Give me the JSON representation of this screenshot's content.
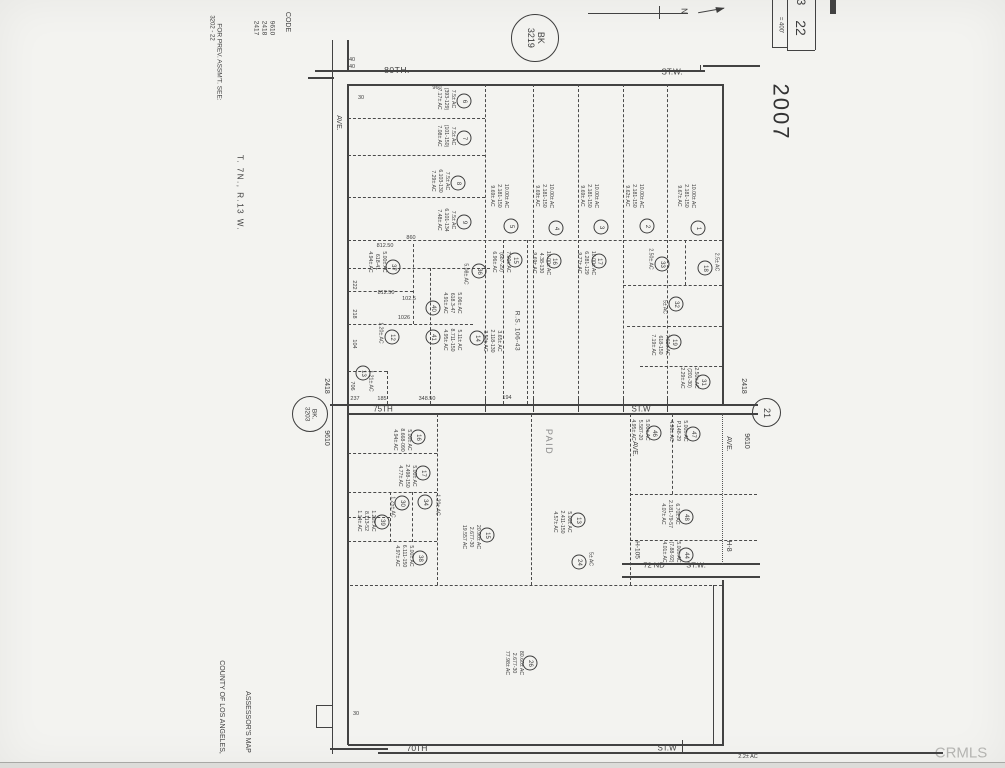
{
  "annotations": {
    "prev_assmt": "FOR PREV. ASSM'T. SEE:",
    "prev_assmt_ref": "3202 - 22",
    "code_label": "CODE",
    "code_list": [
      "9610",
      "2418",
      "2417"
    ],
    "township": "T. 7N., R.13 W.",
    "book_circle_top": "BK\n3219",
    "book_circle_left": "BK.\n3203",
    "page_circle": "21",
    "year_stamp": "2007",
    "scale_text": "= 400'",
    "sheet_number": "22",
    "sheet_number_partial": "3",
    "north_letter": "N",
    "assessors_map": "ASSESSOR'S MAP",
    "county_line": "COUNTY OF LOS ANGELES,",
    "watermark": "CRMLS",
    "code_left_top": "2418",
    "code_left_bottom": "9610",
    "code_right_top": "2418",
    "code_right_bottom": "9610",
    "paid_stamp": "PAID",
    "survey_ref": "R.S. 106-43",
    "district_left": "H-105",
    "district_right": "H-8"
  },
  "streets": {
    "s80": "80TH.",
    "s80_sfx": "ST.W.",
    "s75": "75TH",
    "s75_sfx": "ST.W",
    "s72": "72 ND",
    "s72_sfx": "ST.W.",
    "s70": "70TH",
    "s70_sfx": "ST.W",
    "avenue": "AVE."
  },
  "map": {
    "dims": [
      {
        "t": "960",
        "x": 437,
        "y": 88
      },
      {
        "t": "860",
        "x": 411,
        "y": 238
      },
      {
        "t": "812.50",
        "x": 385,
        "y": 246
      },
      {
        "t": "812.50",
        "x": 386,
        "y": 293
      },
      {
        "t": "102.5",
        "x": 409,
        "y": 299
      },
      {
        "t": "1026",
        "x": 404,
        "y": 318
      },
      {
        "t": "237",
        "x": 355,
        "y": 399
      },
      {
        "t": "185",
        "x": 382,
        "y": 399
      },
      {
        "t": "348.50",
        "x": 427,
        "y": 399
      },
      {
        "t": "194",
        "x": 507,
        "y": 398
      },
      {
        "t": "30",
        "x": 361,
        "y": 98
      },
      {
        "t": "30",
        "x": 356,
        "y": 714
      },
      {
        "t": "40",
        "x": 352,
        "y": 60
      },
      {
        "t": "40",
        "x": 352,
        "y": 67
      },
      {
        "t": "2.2± AC",
        "x": 748,
        "y": 757
      },
      {
        "t": "222",
        "x": 354,
        "y": 285,
        "r": 1
      },
      {
        "t": "218",
        "x": 354,
        "y": 314,
        "r": 1
      },
      {
        "t": "104",
        "x": 354,
        "y": 344,
        "r": 1
      },
      {
        "t": "706",
        "x": 352,
        "y": 386,
        "r": 1
      }
    ],
    "parcels": [
      {
        "n": "6",
        "cx": 464,
        "cy": 101,
        "t": "7.5± AC\n(393-129)\n7.17± AC",
        "tx": 446,
        "ty": 99
      },
      {
        "n": "7",
        "cx": 464,
        "cy": 138,
        "t": "7.5± AC\n(101-150)\n7.08± AC",
        "tx": 446,
        "ty": 136
      },
      {
        "n": "8",
        "cx": 458,
        "cy": 183,
        "t": "7.5± AC\n6.103-130\n7.29± AC",
        "tx": 440,
        "ty": 181
      },
      {
        "n": "9",
        "cx": 464,
        "cy": 222,
        "t": "7.5± AC\n6.101-134\n7.48± AC",
        "tx": 446,
        "ty": 220
      },
      {
        "n": "5",
        "cx": 511,
        "cy": 226,
        "t": "10.00± AC\n2.181-150\n9.69± AC",
        "tx": 499,
        "ty": 196
      },
      {
        "n": "4",
        "cx": 556,
        "cy": 228,
        "t": "10.00± AC\n2.181-150\n9.69± AC",
        "tx": 544,
        "ty": 196
      },
      {
        "n": "3",
        "cx": 601,
        "cy": 227,
        "t": "10.00± AC\n2.181-150\n9.69± AC",
        "tx": 589,
        "ty": 196
      },
      {
        "n": "2",
        "cx": 647,
        "cy": 226,
        "t": "10.00± AC\n2.181-150\n9.62± AC",
        "tx": 634,
        "ty": 196
      },
      {
        "n": "1",
        "cx": 698,
        "cy": 228,
        "t": "10.00± AC\n2.181-150\n9.67± AC",
        "tx": 686,
        "ty": 196
      },
      {
        "n": "37",
        "cx": 393,
        "cy": 267,
        "t": "5.00± AC\n618-41\n4.94± AC",
        "tx": 377,
        "ty": 262
      },
      {
        "n": "36",
        "cx": 479,
        "cy": 271,
        "t": "5.08± AC",
        "tx": 465,
        "ty": 274
      },
      {
        "n": "40",
        "cx": 433,
        "cy": 308,
        "t": "5.06± AC\n618.3-47\n4.91± AC",
        "tx": 452,
        "ty": 303
      },
      {
        "n": "41",
        "cx": 433,
        "cy": 337,
        "t": "5.11± AC\n8.711-150\n4.95± AC",
        "tx": 452,
        "ty": 340
      },
      {
        "n": "14",
        "cx": 477,
        "cy": 338,
        "t": "3.65± AC\n2.118-130\n3.50± AC",
        "tx": 492,
        "ty": 341
      },
      {
        "n": "12",
        "cx": 392,
        "cy": 337,
        "t": "1.20± AC",
        "tx": 380,
        "ty": 333
      },
      {
        "n": "13",
        "cx": 363,
        "cy": 373,
        "t": "1.21± AC",
        "tx": 370,
        "ty": 381
      },
      {
        "n": "15",
        "cx": 515,
        "cy": 260,
        "t": "7.00± AC\n(687-29)\n6.96± AC",
        "tx": 501,
        "ty": 262
      },
      {
        "n": "16",
        "cx": 554,
        "cy": 261,
        "t": "10.00± AC\n4.38-130\n9.69± AC",
        "tx": 541,
        "ty": 263
      },
      {
        "n": "17",
        "cx": 599,
        "cy": 261,
        "t": "10.00± AC\n6.281-129\n9.77± AC",
        "tx": 586,
        "ty": 263
      },
      {
        "n": "33",
        "cx": 662,
        "cy": 264,
        "t": "2.50± AC",
        "tx": 650,
        "ty": 259
      },
      {
        "n": "18",
        "cx": 705,
        "cy": 268,
        "t": "2.5± AC",
        "tx": 716,
        "ty": 262
      },
      {
        "n": "32",
        "cx": 676,
        "cy": 304,
        "t": "5± AC",
        "tx": 664,
        "ty": 307
      },
      {
        "n": "19",
        "cx": 674,
        "cy": 342,
        "t": "7.60± AC\n618-150\n7.19± AC",
        "tx": 660,
        "ty": 345
      },
      {
        "n": "31",
        "cx": 703,
        "cy": 382,
        "t": "2.50± AC\n(201-30)\n2.29± AC",
        "tx": 689,
        "ty": 378
      },
      {
        "n": "16",
        "cx": 418,
        "cy": 437,
        "t": "5.00± AC\n8.668-090\n4.94± AC",
        "tx": 402,
        "ty": 440
      },
      {
        "n": "17",
        "cx": 423,
        "cy": 473,
        "t": "5.00± AC\n2.498-150\n4.77± AC",
        "tx": 407,
        "ty": 476
      },
      {
        "n": "30",
        "cx": 402,
        "cy": 503,
        "t": "1.25± AC",
        "tx": 392,
        "ty": 507
      },
      {
        "n": "34",
        "cx": 425,
        "cy": 502,
        "t": "1.20± AC",
        "tx": 437,
        "ty": 505
      },
      {
        "n": "39",
        "cx": 382,
        "cy": 522,
        "t": "1.20± AC\n8.113-52\n1.14± AC",
        "tx": 366,
        "ty": 521
      },
      {
        "n": "38",
        "cx": 420,
        "cy": 558,
        "t": "5.00± AC\n6.111-150\n4.97± AC",
        "tx": 404,
        "ty": 556
      },
      {
        "n": "15",
        "cx": 487,
        "cy": 535,
        "t": "20.90± AC\n2.677-30\n19.557 AC",
        "tx": 471,
        "ty": 537
      },
      {
        "n": "13",
        "cx": 578,
        "cy": 520,
        "t": "5.00± AC\n2.411-150\n4.57± AC",
        "tx": 562,
        "ty": 522
      },
      {
        "n": "24",
        "cx": 579,
        "cy": 562,
        "t": "5± AC",
        "tx": 590,
        "ty": 559
      },
      {
        "n": "46",
        "cx": 654,
        "cy": 433,
        "t": "5.00± AC\n5.587-20\n4.95± AC",
        "tx": 640,
        "ty": 430
      },
      {
        "n": "47",
        "cx": 693,
        "cy": 434,
        "t": "5.00± AC\nP.148-29\n4.98± AC",
        "tx": 678,
        "ty": 431
      },
      {
        "n": "48",
        "cx": 686,
        "cy": 517,
        "t": "6.70± AC\n2.181-79-57\n4.07± AC",
        "tx": 670,
        "ty": 514
      },
      {
        "n": "44",
        "cx": 686,
        "cy": 555,
        "t": "5.00± AC\n(7.88-92)\n4.01± AC",
        "tx": 671,
        "ty": 552
      },
      {
        "n": "26",
        "cx": 530,
        "cy": 663,
        "t": "80.60± AC\n2.677-30\n77.98± AC",
        "tx": 514,
        "ty": 663
      }
    ]
  }
}
